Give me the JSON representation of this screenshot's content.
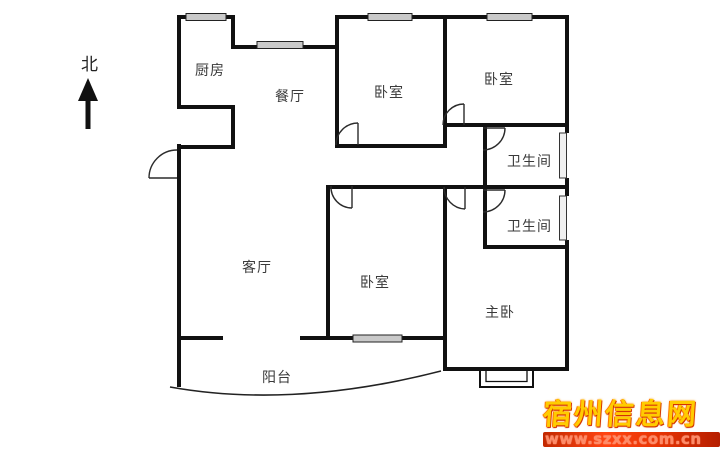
{
  "compass": {
    "north": "北"
  },
  "rooms": {
    "kitchen": "厨房",
    "dining": "餐厅",
    "bedroom_top_left": "卧室",
    "bedroom_top_right": "卧室",
    "bathroom_upper": "卫生间",
    "bathroom_lower": "卫生间",
    "living": "客厅",
    "bedroom_bottom": "卧室",
    "master": "主卧",
    "balcony": "阳台"
  },
  "watermark": {
    "site_name": "宿州信息网",
    "site_url": "www.szxx.com.cn",
    "name_color": "#ffcc00",
    "bar_gradient": [
      "#c22800",
      "#ff4412",
      "#b51e00"
    ],
    "url_color": "#ff8a66"
  },
  "colors": {
    "background": "#ffffff",
    "wall": "#111111",
    "label_text": "#3a3a3a",
    "window_fill": "#c9c9c9"
  }
}
